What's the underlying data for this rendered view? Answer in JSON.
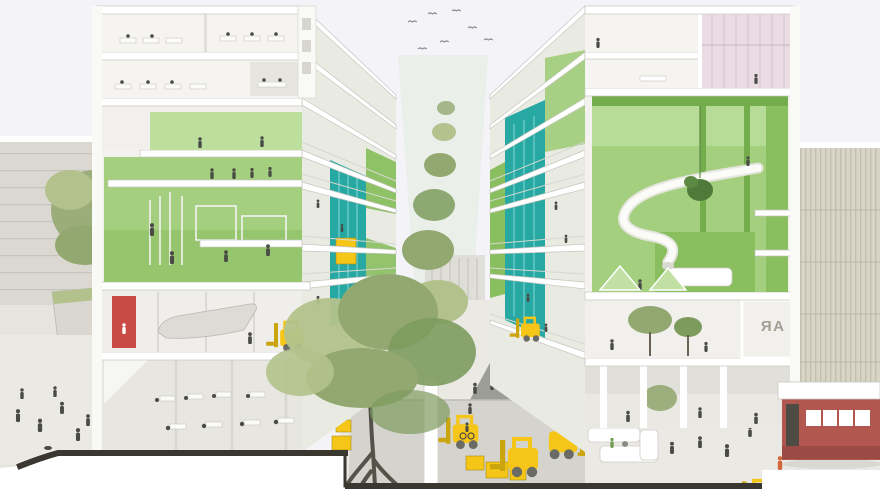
{
  "scene": {
    "type": "architectural-section-rendering",
    "description": "Cutaway perspective rendering: two mid-rise buildings with bright green interior halls and teal elevator cores face a tree-lined courtyard; the section cut reveals a sunken service street with yellow forklifts and crates; pedestrians fill the plazas, a red kiosk and striped background buildings frame the edges, birds fly overhead.",
    "signage_text": "AR"
  },
  "colors": {
    "sky": "#f4f3f8",
    "section_white": "#f3f2ee",
    "slab": "#ffffff",
    "slab_edge": "#c7c5bf",
    "wall_end": "#f9f9f6",
    "green_wall": "#a3cf7e",
    "green_light": "#bcdf9e",
    "green_deep": "#8abf5f",
    "green_dark": "#74ae4c",
    "teal": "#27a8a2",
    "teal_light": "#66c9c4",
    "yellow": "#f5c517",
    "yellow_dark": "#a98f12",
    "red_panel": "#c94b44",
    "kiosk_red": "#b2574f",
    "pink_glass": "#e9dce2",
    "bg_gray": "#dbd8d2",
    "bg_beige": "#d8d4c6",
    "ground": "#ebe9e4",
    "ground_dark": "#d4d3ce",
    "path_gray": "#8f8f8a",
    "cut": "#39372f",
    "figure": "#4a4a46",
    "tree_green": "#93a871",
    "tree_light": "#b3c28c",
    "tree_dark": "#7e9b5e",
    "trunk": "#55524a"
  }
}
